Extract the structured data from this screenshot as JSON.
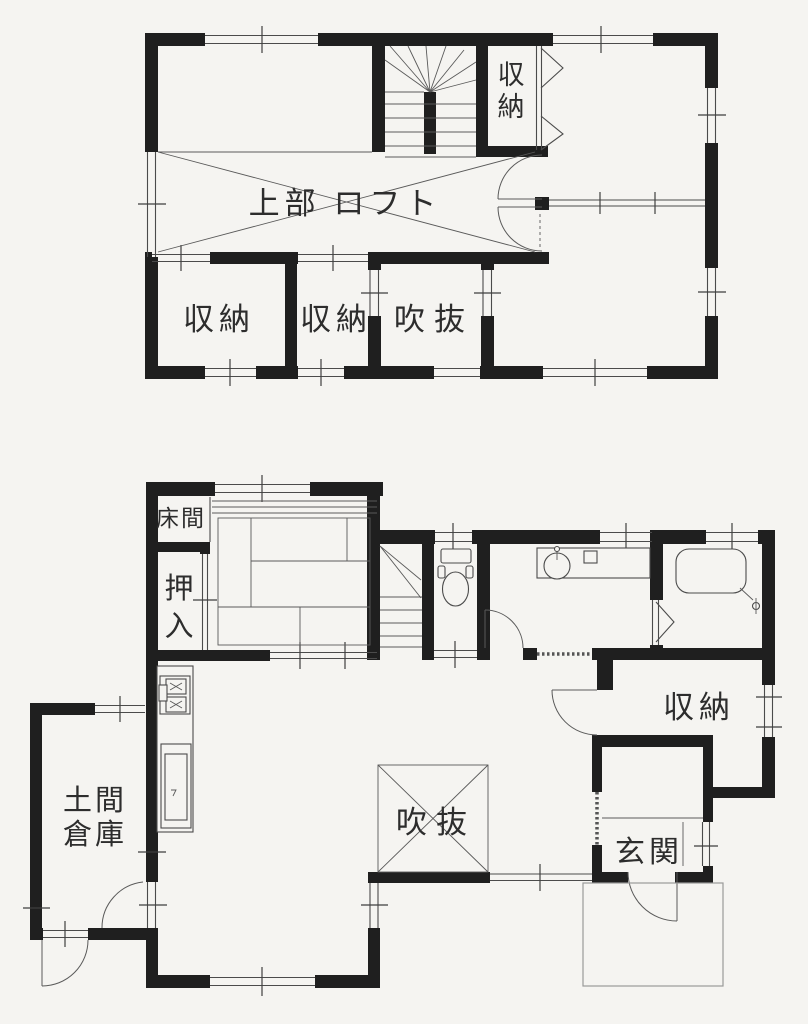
{
  "document": {
    "type": "japanese-house-floor-plan",
    "sheets": [
      "loft-floor",
      "first-floor"
    ]
  },
  "colors": {
    "background": "#f5f4f1",
    "wall": "#1f1f1f",
    "line": "#4b4b4b",
    "text": "#2d2d2d",
    "porch_line": "#9a9a9a"
  },
  "floors": {
    "upper": {
      "labels": {
        "loft": "上部 ロフト",
        "storage_top_chars": [
          "収",
          "納"
        ],
        "storage_a": "収納",
        "storage_b": "収納",
        "void": "吹抜"
      }
    },
    "lower": {
      "labels": {
        "tokonoma": "床間",
        "oshiire_chars": [
          "押",
          "入"
        ],
        "doma_lines": [
          "土間",
          "倉庫"
        ],
        "void": "吹抜",
        "storage": "収納",
        "genkan": "玄関"
      }
    }
  }
}
